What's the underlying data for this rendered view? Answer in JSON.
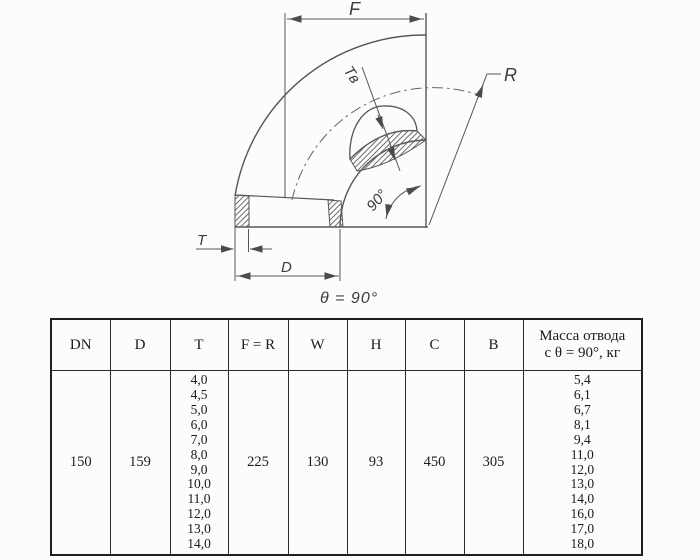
{
  "drawing": {
    "labels": {
      "f": "F",
      "r": "R",
      "t_inner_wall": "Tв",
      "angle": "90°",
      "t": "T",
      "d": "D"
    },
    "caption": "θ = 90°",
    "colors": {
      "line": "#56565a",
      "paper": "#fcfcfb",
      "table_border": "#2c2c2c"
    }
  },
  "table": {
    "headers": [
      "DN",
      "D",
      "T",
      "F = R",
      "W",
      "H",
      "C",
      "B"
    ],
    "mass_header": {
      "line1": "Масса отвода",
      "line2": "с θ =  90°, кг"
    },
    "row": {
      "dn": "150",
      "d": "159",
      "f_r": "225",
      "w": "130",
      "h": "93",
      "c": "450",
      "b": "305",
      "t_values": [
        "4,0",
        "4,5",
        "5,0",
        "6,0",
        "7,0",
        "8,0",
        "9,0",
        "10,0",
        "11,0",
        "12,0",
        "13,0",
        "14,0"
      ],
      "mass_values": [
        "5,4",
        "6,1",
        "6,7",
        "8,1",
        "9,4",
        "11,0",
        "12,0",
        "13,0",
        "14,0",
        "16,0",
        "17,0",
        "18,0"
      ]
    }
  }
}
